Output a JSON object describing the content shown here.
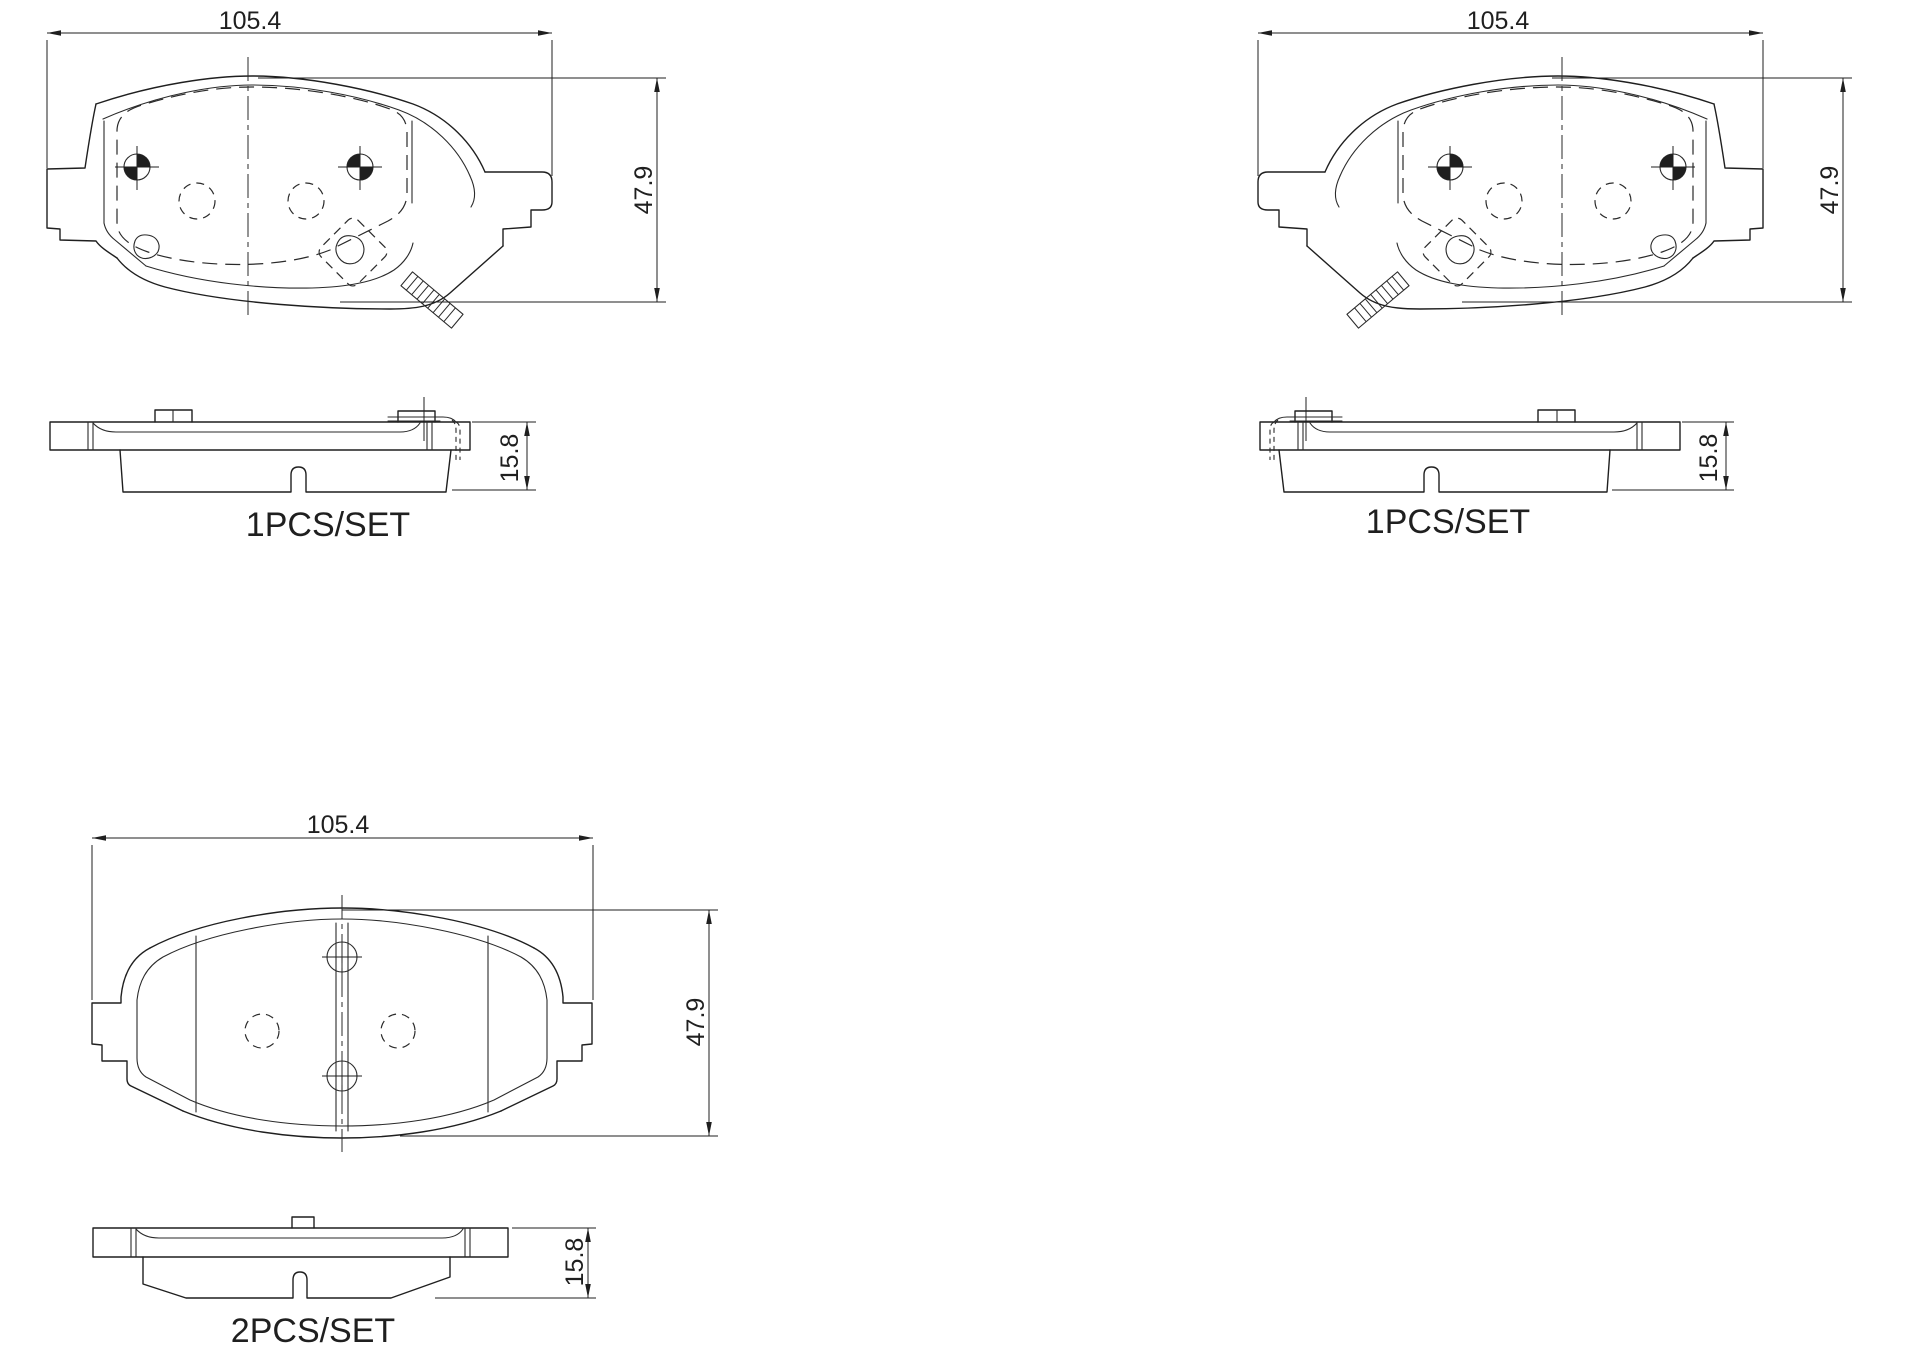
{
  "colors": {
    "line": "#1f1f1f",
    "background": "#ffffff"
  },
  "groups": [
    {
      "id": "outer-pad-left",
      "width_mm": "105.4",
      "height_mm": "47.9",
      "thickness_mm": "15.8",
      "set_label": "1PCS/SET"
    },
    {
      "id": "outer-pad-right",
      "width_mm": "105.4",
      "height_mm": "47.9",
      "thickness_mm": "15.8",
      "set_label": "1PCS/SET"
    },
    {
      "id": "inner-pad",
      "width_mm": "105.4",
      "height_mm": "47.9",
      "thickness_mm": "15.8",
      "set_label": "2PCS/SET"
    }
  ]
}
